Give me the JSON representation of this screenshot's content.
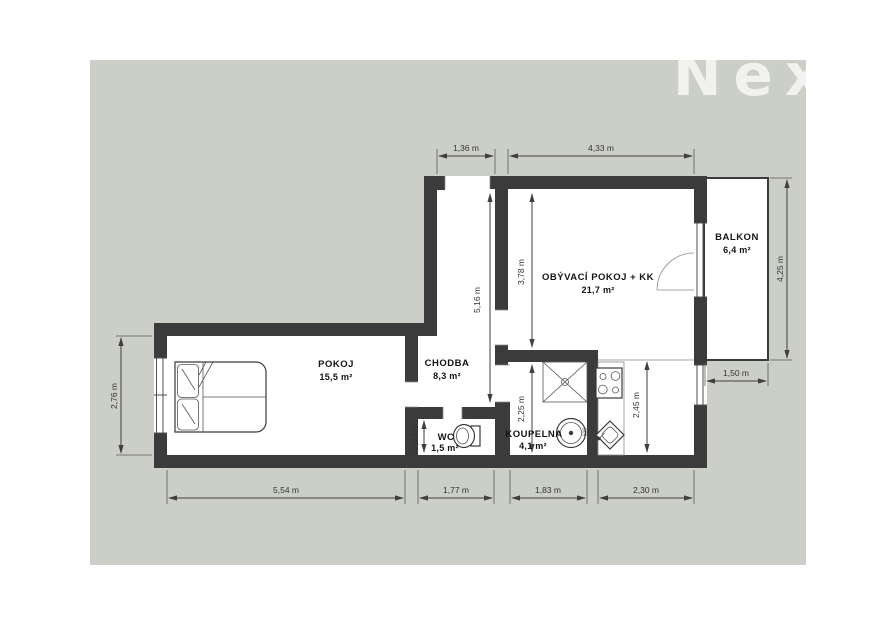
{
  "watermark": {
    "text": "Nex"
  },
  "colors": {
    "canvas_background": "#cccfc7",
    "wall": "#3b3b3b",
    "interior": "#ffffff"
  },
  "rooms": {
    "pokoj": {
      "name": "POKOJ",
      "area": "15,5 m²"
    },
    "chodba": {
      "name": "CHODBA",
      "area": "8,3 m²"
    },
    "wc": {
      "name": "WC",
      "area": "1,5 m²"
    },
    "koupelna": {
      "name": "KOUPELNA",
      "area": "4,1 m²"
    },
    "obyvaci": {
      "name": "OBÝVACÍ POKOJ + KK",
      "area": "21,7 m²"
    },
    "balkon": {
      "name": "BALKON",
      "area": "6,4 m²"
    }
  },
  "dimensions": {
    "entry_width": "1,36 m",
    "living_width": "4,33 m",
    "balcony_height": "4,25 m",
    "balcony_width": "1,50 m",
    "pokoj_width": "5,54 m",
    "chodba_width": "1,77 m",
    "koupelna_width": "1,83 m",
    "kitchen_width": "2,30 m",
    "pokoj_height": "2,76 m",
    "corridor_height": "5,16 m",
    "living_height": "3,78 m",
    "koupelna_height": "2,25 m",
    "kitchen_height": "2,45 m",
    "wc_height": "0,87 m"
  },
  "appliances": {
    "washer_label": "610"
  }
}
